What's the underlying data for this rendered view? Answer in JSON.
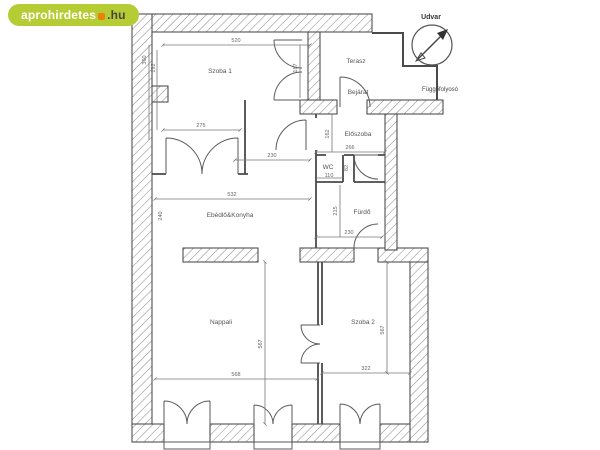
{
  "watermark": {
    "brand": "aprohirdetes",
    "suffix": ".hu",
    "bg_color": "#b6cc35",
    "brand_color": "#ffffff",
    "dot_color": "#e8820c",
    "suffix_color": "#45453a"
  },
  "plan": {
    "outside": {
      "udvar": "Udvar",
      "fuggofolyoso": "Függőfolyosó"
    },
    "rooms": {
      "szoba1": "Szoba 1",
      "terasz": "Terasz",
      "bejarat": "Bejárat",
      "eloszoba": "Előszoba",
      "wc": "WC",
      "furdo": "Fürdő",
      "ebedlo": "Ebédlő&Konyha",
      "nappali": "Nappali",
      "szoba2": "Szoba 2"
    },
    "dims": {
      "szoba1_width": "520",
      "szoba1_part_width": "275",
      "szoba1_height": "360",
      "szoba1_height_inner": "192",
      "corridor_height": "187",
      "hall_width": "230",
      "eloszoba_width": "266",
      "eloszoba_height": "162",
      "wc_width": "110",
      "wc_height": "82",
      "furdo_width": "230",
      "furdo_height": "215",
      "ebedlo_width": "532",
      "ebedlo_height": "240",
      "nappali_width": "568",
      "nappali_height": "567",
      "szoba2_width": "322",
      "szoba2_height": "567"
    },
    "line_color": "#4a4a4a",
    "hatch_color": "#8f8f8f"
  }
}
